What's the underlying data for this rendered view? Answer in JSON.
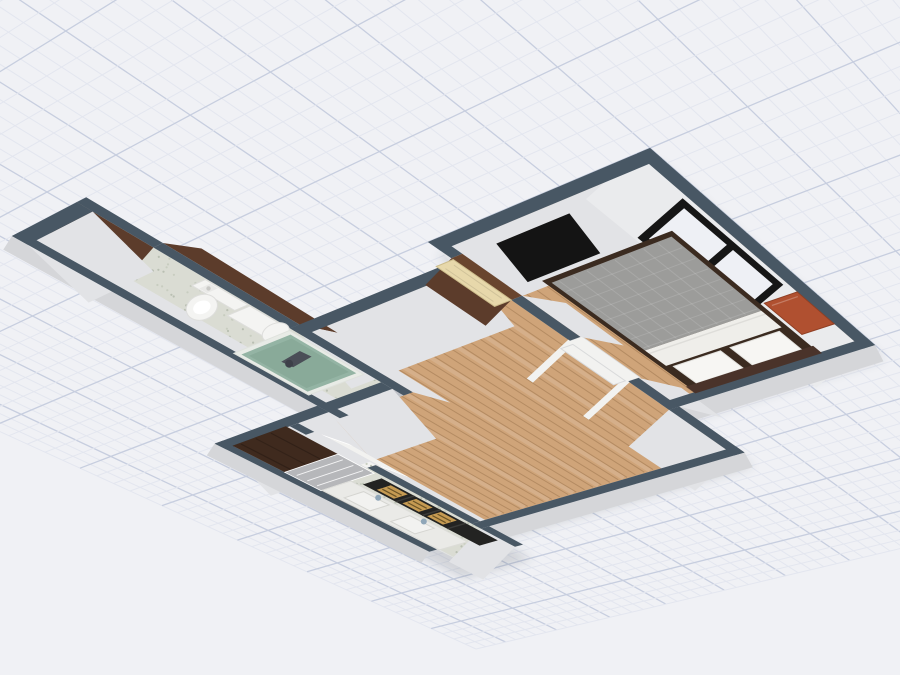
{
  "app": {
    "name": "3D Floor Plan View",
    "view_mode": "3d-perspective"
  },
  "canvas": {
    "width": 900,
    "height": 675
  },
  "colors": {
    "canvas_bg": "#f0f1f5",
    "grid_minor": "#e3e6ef",
    "grid_major": "#c7cedf",
    "wall_top": "#485764",
    "wall_face": "#e2e3e6",
    "wall_face_light": "#eaebed",
    "wall_outer": "#d5d6d9",
    "wood_wall": "#5c3c2b",
    "wood_wall_top": "#69452e",
    "floor_wood": "#cfa479",
    "plank_line": "rgba(120,84,48,0.30)",
    "plank_hi": "rgba(255,255,255,0.13)",
    "terrazzo": "#dadcd3",
    "speck1": "#b9bfb2",
    "speck2": "#c8cdc0",
    "door_cream": "#e7d8ab",
    "door_cream_edge": "#cdbd8d",
    "white_frame": "#f2f2f0",
    "frame_edge": "#d9dadb",
    "tv": "#141414",
    "window_frame": "#161616",
    "glass": "#eef0f5",
    "tile": "#f7f7f6",
    "bed_frame": "#3b2b20",
    "duvet": "#9c9c9a",
    "sheet": "#efeeea",
    "pillow": "#f7f6f3",
    "pillow_edge": "#e2e1dd",
    "headboard": "#4a332a",
    "nightstand": "#b05030",
    "nightstand_edge": "#8f3f24",
    "cabinet": "#3f2a1e",
    "cabinet_front": "#b6b7ba",
    "counter": "#eaeae7",
    "counter_edge": "#dcdcd8",
    "basin": "#f2f2f0",
    "basin_edge": "#d5d5d1",
    "faucet": "#8fa6b8",
    "rack": "#232322",
    "rack_line": "#3a3a38",
    "crate": "#c59a52",
    "crate_slat": "#6b5427",
    "shower_rim": "#e8ebe6",
    "shower_glass": "#8fb1a0",
    "shower_inner": "#7da08e",
    "handle": "#4a4e57",
    "porcelain": "#f4f4f2",
    "porcelain_edge": "#dededc",
    "shadow": "rgba(60,62,72,0.30)"
  },
  "scene": {
    "rooms": [
      {
        "name": "bathroom",
        "floor": "terrazzo"
      },
      {
        "name": "kitchen",
        "floor": "terrazzo"
      },
      {
        "name": "living-room",
        "floor": "wood"
      },
      {
        "name": "bedroom",
        "floor": "wood"
      }
    ],
    "objects": [
      "grid-floor",
      "toilet",
      "shower",
      "water-heater",
      "kitchen-tall-cabinet",
      "kitchen-counter",
      "kitchen-sink",
      "kitchen-shelf-rack",
      "kitchen-window",
      "kitchen-door",
      "front-door",
      "interior-doorway",
      "bed",
      "nightstand",
      "tv",
      "bedroom-window"
    ]
  }
}
